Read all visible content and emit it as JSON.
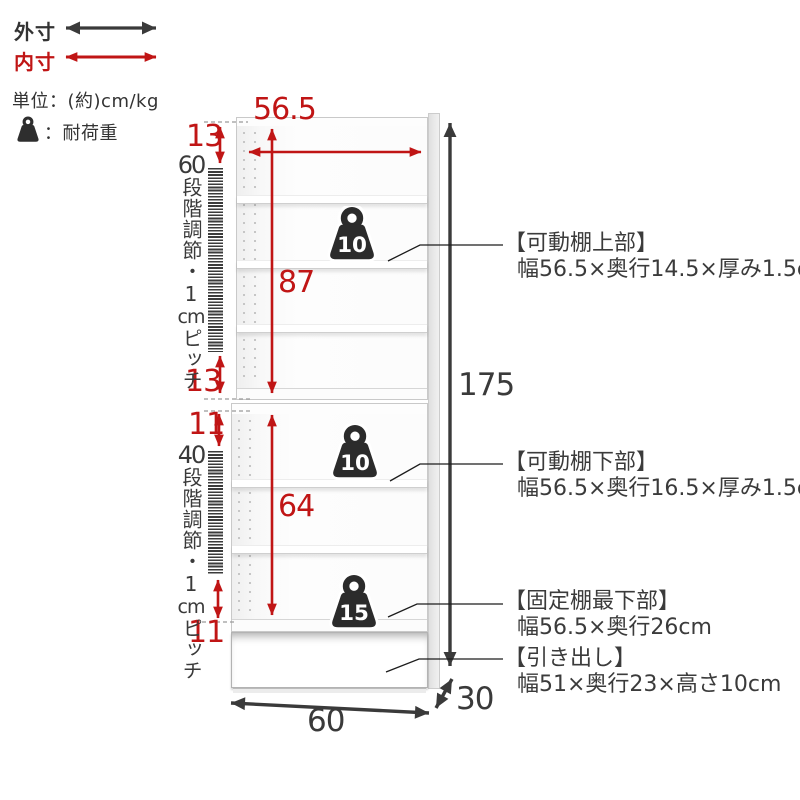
{
  "legend": {
    "outer_dim_label": "外寸",
    "inner_dim_label": "内寸",
    "units_label": "単位：(約)cm/kg",
    "load_capacity_label": "：耐荷重"
  },
  "dimensions": {
    "inner_color": "#c01515",
    "outer_color": "#3a3a3a",
    "shelf_inner_width": "56.5",
    "upper_top_gap": "13",
    "upper_inner_height": "87",
    "upper_bottom_gap": "13",
    "lower_top_gap": "11",
    "lower_inner_height": "64",
    "lower_bottom_gap": "11",
    "total_height": "175",
    "base_width": "60",
    "base_depth": "30"
  },
  "adjustment": {
    "upper": {
      "steps": "60",
      "label": "段階調節・1",
      "unit": "cm",
      "pitch": "ピッチ"
    },
    "lower": {
      "steps": "40",
      "label": "段階調節・1",
      "unit": "cm",
      "pitch": "ピッチ"
    }
  },
  "load_badges": [
    {
      "value": "10"
    },
    {
      "value": "10"
    },
    {
      "value": "15"
    }
  ],
  "annotations": [
    {
      "title": "【可動棚上部】",
      "detail": "幅56.5×奥行14.5×厚み1.5cm"
    },
    {
      "title": "【可動棚下部】",
      "detail": "幅56.5×奥行16.5×厚み1.5cm"
    },
    {
      "title": "【固定棚最下部】",
      "detail": "幅56.5×奥行26cm"
    },
    {
      "title": "【引き出し】",
      "detail": "幅51×奥行23×高さ10cm"
    }
  ]
}
